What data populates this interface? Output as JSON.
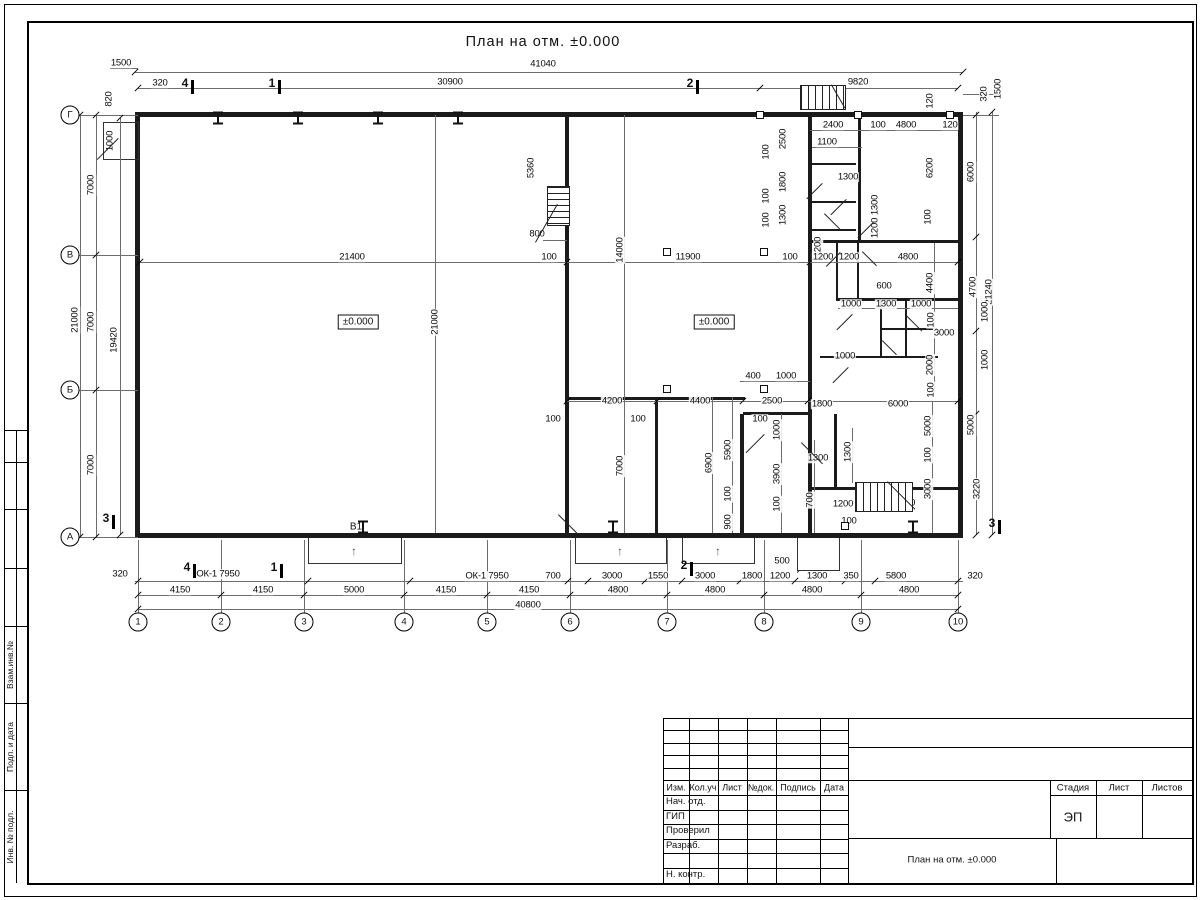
{
  "page": {
    "title": "План на отм. ±0.000"
  },
  "drawing": {
    "labels": [
      {
        "t": "41040",
        "x": 543,
        "y": 64
      },
      {
        "t": "30900",
        "x": 450,
        "y": 82
      },
      {
        "t": "9820",
        "x": 858,
        "y": 82
      },
      {
        "t": "1500",
        "x": 121,
        "y": 63
      },
      {
        "t": "320",
        "x": 160,
        "y": 83
      },
      {
        "t": "820",
        "x": 109,
        "y": 99,
        "r": 1
      },
      {
        "t": "1000",
        "x": 110,
        "y": 141,
        "r": 1
      },
      {
        "t": "120",
        "x": 930,
        "y": 101,
        "r": 1
      },
      {
        "t": "320",
        "x": 984,
        "y": 94,
        "r": 1
      },
      {
        "t": "1500",
        "x": 998,
        "y": 89,
        "r": 1
      },
      {
        "t": "2400",
        "x": 833,
        "y": 125
      },
      {
        "t": "100",
        "x": 878,
        "y": 125
      },
      {
        "t": "4800",
        "x": 906,
        "y": 125
      },
      {
        "t": "120",
        "x": 950,
        "y": 125
      },
      {
        "t": "1100",
        "x": 827,
        "y": 142
      },
      {
        "t": "2500",
        "x": 783,
        "y": 139,
        "r": 1
      },
      {
        "t": "100",
        "x": 766,
        "y": 152,
        "r": 1
      },
      {
        "t": "1800",
        "x": 783,
        "y": 182,
        "r": 1
      },
      {
        "t": "100",
        "x": 766,
        "y": 196,
        "r": 1
      },
      {
        "t": "1300",
        "x": 783,
        "y": 215,
        "r": 1
      },
      {
        "t": "100",
        "x": 766,
        "y": 220,
        "r": 1
      },
      {
        "t": "1300",
        "x": 848,
        "y": 177
      },
      {
        "t": "1300",
        "x": 875,
        "y": 205,
        "r": 1
      },
      {
        "t": "1200",
        "x": 875,
        "y": 228,
        "r": 1
      },
      {
        "t": "1200",
        "x": 818,
        "y": 247,
        "r": 1
      },
      {
        "t": "6200",
        "x": 930,
        "y": 168,
        "r": 1
      },
      {
        "t": "6000",
        "x": 971,
        "y": 172,
        "r": 1
      },
      {
        "t": "100",
        "x": 928,
        "y": 217,
        "r": 1
      },
      {
        "t": "5360",
        "x": 531,
        "y": 168,
        "r": 1
      },
      {
        "t": "800",
        "x": 537,
        "y": 234
      },
      {
        "t": "21400",
        "x": 352,
        "y": 257
      },
      {
        "t": "100",
        "x": 549,
        "y": 257
      },
      {
        "t": "14000",
        "x": 620,
        "y": 250,
        "r": 1
      },
      {
        "t": "11900",
        "x": 688,
        "y": 257
      },
      {
        "t": "100",
        "x": 790,
        "y": 257
      },
      {
        "t": "1200",
        "x": 823,
        "y": 257
      },
      {
        "t": "1200",
        "x": 849,
        "y": 257
      },
      {
        "t": "4800",
        "x": 908,
        "y": 257
      },
      {
        "t": "600",
        "x": 884,
        "y": 286
      },
      {
        "t": "1000",
        "x": 851,
        "y": 304
      },
      {
        "t": "1300",
        "x": 886,
        "y": 304
      },
      {
        "t": "1000",
        "x": 921,
        "y": 304
      },
      {
        "t": "100",
        "x": 931,
        "y": 320,
        "r": 1
      },
      {
        "t": "4400",
        "x": 930,
        "y": 283,
        "r": 1
      },
      {
        "t": "4700",
        "x": 973,
        "y": 287,
        "r": 1
      },
      {
        "t": "21240",
        "x": 989,
        "y": 292,
        "r": 1
      },
      {
        "t": "1000",
        "x": 985,
        "y": 312,
        "r": 1
      },
      {
        "t": "3000",
        "x": 944,
        "y": 333
      },
      {
        "t": "1000",
        "x": 985,
        "y": 360,
        "r": 1
      },
      {
        "t": "1000",
        "x": 845,
        "y": 356
      },
      {
        "t": "2000",
        "x": 930,
        "y": 365,
        "r": 1
      },
      {
        "t": "100",
        "x": 931,
        "y": 390,
        "r": 1
      },
      {
        "t": "21000",
        "x": 435,
        "y": 322,
        "r": 1
      },
      {
        "t": "400",
        "x": 753,
        "y": 376
      },
      {
        "t": "1000",
        "x": 786,
        "y": 376
      },
      {
        "t": "4200",
        "x": 612,
        "y": 401
      },
      {
        "t": "100",
        "x": 553,
        "y": 419
      },
      {
        "t": "100",
        "x": 638,
        "y": 419
      },
      {
        "t": "100",
        "x": 760,
        "y": 419
      },
      {
        "t": "4400",
        "x": 700,
        "y": 401
      },
      {
        "t": "2500",
        "x": 772,
        "y": 401
      },
      {
        "t": "1800",
        "x": 822,
        "y": 404
      },
      {
        "t": "6000",
        "x": 898,
        "y": 404
      },
      {
        "t": "7000",
        "x": 620,
        "y": 466,
        "r": 1
      },
      {
        "t": "6900",
        "x": 709,
        "y": 463,
        "r": 1
      },
      {
        "t": "5900",
        "x": 728,
        "y": 450,
        "r": 1
      },
      {
        "t": "100",
        "x": 728,
        "y": 494,
        "r": 1
      },
      {
        "t": "900",
        "x": 728,
        "y": 522,
        "r": 1
      },
      {
        "t": "1000",
        "x": 777,
        "y": 430,
        "r": 1
      },
      {
        "t": "3900",
        "x": 777,
        "y": 474,
        "r": 1
      },
      {
        "t": "100",
        "x": 777,
        "y": 504,
        "r": 1
      },
      {
        "t": "700",
        "x": 810,
        "y": 500,
        "r": 1
      },
      {
        "t": "1300",
        "x": 818,
        "y": 458
      },
      {
        "t": "1300",
        "x": 848,
        "y": 452,
        "r": 1
      },
      {
        "t": "5000",
        "x": 928,
        "y": 426,
        "r": 1
      },
      {
        "t": "100",
        "x": 928,
        "y": 455,
        "r": 1
      },
      {
        "t": "3000",
        "x": 928,
        "y": 489,
        "r": 1
      },
      {
        "t": "5000",
        "x": 971,
        "y": 425,
        "r": 1
      },
      {
        "t": "3220",
        "x": 977,
        "y": 489,
        "r": 1
      },
      {
        "t": "1200",
        "x": 843,
        "y": 504
      },
      {
        "t": "100",
        "x": 849,
        "y": 521
      },
      {
        "t": "4800",
        "x": 905,
        "y": 503
      },
      {
        "t": "500",
        "x": 782,
        "y": 561
      },
      {
        "t": "320",
        "x": 120,
        "y": 574
      },
      {
        "t": "ОК-1 7950",
        "x": 218,
        "y": 574
      },
      {
        "t": "4150",
        "x": 180,
        "y": 590
      },
      {
        "t": "4150",
        "x": 263,
        "y": 590
      },
      {
        "t": "5000",
        "x": 354,
        "y": 590
      },
      {
        "t": "4150",
        "x": 446,
        "y": 590
      },
      {
        "t": "4150",
        "x": 529,
        "y": 590
      },
      {
        "t": "ОК-1 7950",
        "x": 487,
        "y": 576
      },
      {
        "t": "700",
        "x": 553,
        "y": 576
      },
      {
        "t": "3000",
        "x": 612,
        "y": 576
      },
      {
        "t": "1550",
        "x": 658,
        "y": 576
      },
      {
        "t": "3000",
        "x": 705,
        "y": 576
      },
      {
        "t": "1800",
        "x": 752,
        "y": 576
      },
      {
        "t": "1200",
        "x": 780,
        "y": 576
      },
      {
        "t": "1300",
        "x": 817,
        "y": 576
      },
      {
        "t": "350",
        "x": 851,
        "y": 576
      },
      {
        "t": "5800",
        "x": 896,
        "y": 576
      },
      {
        "t": "320",
        "x": 975,
        "y": 576
      },
      {
        "t": "4800",
        "x": 618,
        "y": 590
      },
      {
        "t": "4800",
        "x": 715,
        "y": 590
      },
      {
        "t": "4800",
        "x": 812,
        "y": 590
      },
      {
        "t": "4800",
        "x": 909,
        "y": 590
      },
      {
        "t": "40800",
        "x": 528,
        "y": 605
      },
      {
        "t": "7000",
        "x": 91,
        "y": 185,
        "r": 1
      },
      {
        "t": "21000",
        "x": 75,
        "y": 320,
        "r": 1
      },
      {
        "t": "7000",
        "x": 91,
        "y": 322,
        "r": 1
      },
      {
        "t": "19420",
        "x": 114,
        "y": 340,
        "r": 1
      },
      {
        "t": "7000",
        "x": 91,
        "y": 465,
        "r": 1
      }
    ],
    "boxed_labels": [
      {
        "t": "±0.000",
        "x": 358,
        "y": 322
      },
      {
        "t": "±0.000",
        "x": 714,
        "y": 322
      }
    ],
    "notes": [
      {
        "t": "В1",
        "x": 356,
        "y": 527
      }
    ],
    "axis_bottom": [
      {
        "t": "1",
        "x": 138
      },
      {
        "t": "2",
        "x": 221
      },
      {
        "t": "3",
        "x": 304
      },
      {
        "t": "4",
        "x": 404
      },
      {
        "t": "5",
        "x": 487
      },
      {
        "t": "6",
        "x": 570
      },
      {
        "t": "7",
        "x": 667
      },
      {
        "t": "8",
        "x": 764
      },
      {
        "t": "9",
        "x": 861
      },
      {
        "t": "10",
        "x": 958
      }
    ],
    "axis_left": [
      {
        "t": "Г",
        "y": 115
      },
      {
        "t": "В",
        "y": 255
      },
      {
        "t": "Б",
        "y": 390
      },
      {
        "t": "А",
        "y": 537
      }
    ],
    "sections": [
      {
        "t": "4",
        "x": 185,
        "y": 83
      },
      {
        "t": "1",
        "x": 272,
        "y": 83
      },
      {
        "t": "2",
        "x": 690,
        "y": 83
      },
      {
        "t": "4",
        "x": 187,
        "y": 567
      },
      {
        "t": "1",
        "x": 274,
        "y": 567
      },
      {
        "t": "2",
        "x": 684,
        "y": 565
      },
      {
        "t": "3",
        "x": 106,
        "y": 518
      },
      {
        "t": "3",
        "x": 992,
        "y": 523
      }
    ],
    "walls": [
      [
        135,
        112,
        828,
        5
      ],
      [
        135,
        533,
        828,
        5
      ],
      [
        135,
        112,
        5,
        426
      ],
      [
        958,
        112,
        5,
        426
      ],
      [
        565,
        112,
        4,
        426
      ],
      [
        808,
        112,
        4,
        302
      ],
      [
        858,
        112,
        3,
        131
      ],
      [
        808,
        240,
        153,
        3
      ],
      [
        810,
        163,
        46,
        2
      ],
      [
        810,
        201,
        46,
        2
      ],
      [
        810,
        229,
        46,
        2
      ],
      [
        836,
        243,
        2,
        57
      ],
      [
        857,
        243,
        2,
        57
      ],
      [
        836,
        298,
        122,
        3
      ],
      [
        880,
        301,
        2,
        57
      ],
      [
        880,
        328,
        57,
        2
      ],
      [
        905,
        301,
        2,
        57
      ],
      [
        820,
        356,
        118,
        2
      ],
      [
        569,
        397,
        176,
        3
      ],
      [
        655,
        397,
        3,
        136
      ],
      [
        740,
        414,
        4,
        119
      ],
      [
        743,
        412,
        65,
        3
      ],
      [
        808,
        414,
        4,
        73
      ],
      [
        834,
        414,
        3,
        75
      ],
      [
        808,
        487,
        153,
        3
      ],
      [
        808,
        487,
        4,
        46
      ],
      [
        103,
        122,
        34,
        36
      ]
    ],
    "thin_h": [
      [
        135,
        72,
        828
      ],
      [
        138,
        88,
        622
      ],
      [
        760,
        88,
        198
      ],
      [
        110,
        68,
        28
      ],
      [
        140,
        262,
        818
      ],
      [
        567,
        401,
        391
      ],
      [
        838,
        308,
        120
      ],
      [
        740,
        381,
        70
      ],
      [
        810,
        130,
        148
      ],
      [
        812,
        147,
        50
      ],
      [
        543,
        240,
        24
      ],
      [
        135,
        581,
        828
      ],
      [
        138,
        595,
        820
      ],
      [
        138,
        609,
        820
      ],
      [
        78,
        115,
        60
      ],
      [
        78,
        255,
        60
      ],
      [
        78,
        390,
        60
      ],
      [
        78,
        537,
        60
      ],
      [
        963,
        94,
        36
      ],
      [
        963,
        115,
        36
      ]
    ],
    "thin_v": [
      [
        80,
        115,
        422
      ],
      [
        96,
        115,
        422
      ],
      [
        120,
        118,
        417
      ],
      [
        435,
        115,
        418
      ],
      [
        624,
        115,
        418
      ],
      [
        976,
        112,
        423
      ],
      [
        992,
        112,
        423
      ],
      [
        934,
        243,
        149
      ],
      [
        712,
        397,
        136
      ],
      [
        732,
        397,
        136
      ],
      [
        781,
        414,
        119
      ],
      [
        814,
        440,
        93
      ],
      [
        852,
        428,
        55
      ],
      [
        932,
        401,
        132
      ],
      [
        138,
        540,
        74
      ],
      [
        221,
        540,
        74
      ],
      [
        304,
        540,
        74
      ],
      [
        404,
        540,
        74
      ],
      [
        487,
        540,
        74
      ],
      [
        570,
        540,
        74
      ],
      [
        667,
        540,
        74
      ],
      [
        764,
        540,
        74
      ],
      [
        861,
        540,
        74
      ],
      [
        958,
        540,
        74
      ]
    ],
    "ticks_h": [
      {
        "y": 595,
        "xs": [
          138,
          221,
          304,
          404,
          487,
          570,
          667,
          764,
          861,
          958
        ]
      },
      {
        "y": 609,
        "xs": [
          138,
          958
        ]
      },
      {
        "y": 581,
        "xs": [
          138,
          308,
          410,
          568,
          588,
          645,
          682,
          740,
          795,
          845,
          875,
          958
        ]
      },
      {
        "y": 72,
        "xs": [
          135,
          963
        ]
      },
      {
        "y": 88,
        "xs": [
          138,
          760,
          958
        ]
      },
      {
        "y": 262,
        "xs": [
          140,
          567,
          810,
          958
        ]
      },
      {
        "y": 401,
        "xs": [
          567,
          657,
          743,
          808,
          958
        ]
      }
    ],
    "ticks_v": [
      {
        "x": 80,
        "ys": [
          115,
          537
        ]
      },
      {
        "x": 96,
        "ys": [
          115,
          255,
          390,
          537
        ]
      },
      {
        "x": 120,
        "ys": [
          118,
          535
        ]
      },
      {
        "x": 976,
        "ys": [
          115,
          237,
          331,
          414,
          489,
          535
        ]
      },
      {
        "x": 992,
        "ys": [
          112,
          535
        ]
      }
    ],
    "squares": [
      [
        667,
        252
      ],
      [
        764,
        252
      ],
      [
        667,
        389
      ],
      [
        764,
        389
      ],
      [
        760,
        115
      ],
      [
        858,
        115
      ],
      [
        950,
        115
      ],
      [
        845,
        526
      ]
    ],
    "piers_top": [
      [
        218,
        118
      ],
      [
        298,
        118
      ],
      [
        378,
        118
      ],
      [
        458,
        118
      ]
    ],
    "piers_bottom": [
      [
        363,
        527
      ],
      [
        613,
        527
      ],
      [
        913,
        527
      ]
    ],
    "doors": [
      [
        822,
        183,
        45,
        22
      ],
      [
        824,
        214,
        -45,
        22
      ],
      [
        846,
        199,
        45,
        22
      ],
      [
        873,
        222,
        45,
        22
      ],
      [
        840,
        252,
        45,
        20
      ],
      [
        862,
        252,
        -45,
        20
      ],
      [
        852,
        314,
        45,
        22
      ],
      [
        906,
        316,
        -45,
        22
      ],
      [
        882,
        341,
        -45,
        20
      ],
      [
        848,
        367,
        45,
        22
      ],
      [
        764,
        434,
        45,
        26
      ],
      [
        801,
        443,
        -45,
        30
      ],
      [
        558,
        515,
        -45,
        26
      ],
      [
        818,
        551,
        45,
        30
      ],
      [
        118,
        138,
        45,
        30
      ]
    ],
    "stairs": [
      {
        "x": 547,
        "y": 186,
        "w": 21,
        "h": 38,
        "dir": "h",
        "diag": {
          "x": 557,
          "y": 204,
          "len": 44,
          "rot": 30
        }
      },
      {
        "x": 855,
        "y": 482,
        "w": 56,
        "h": 28,
        "dir": "v",
        "diag": {
          "x": 887,
          "y": 482,
          "len": 39,
          "rot": -45
        }
      },
      {
        "x": 800,
        "y": 85,
        "w": 44,
        "h": 23,
        "dir": "v",
        "diag": {
          "x": 831,
          "y": 85,
          "len": 27,
          "rot": -30
        }
      }
    ],
    "platforms": [
      [
        308,
        538,
        92,
        25
      ],
      [
        575,
        538,
        90,
        25
      ],
      [
        682,
        538,
        71,
        25
      ],
      [
        797,
        538,
        41,
        32
      ]
    ],
    "arrows": [
      {
        "x": 354,
        "y": 551
      },
      {
        "x": 620,
        "y": 551
      },
      {
        "x": 718,
        "y": 551
      }
    ]
  },
  "title_block": {
    "cols": [
      "Изм.",
      "Кол.уч",
      "Лист",
      "№док.",
      "Подпись",
      "Дата"
    ],
    "rows": [
      "Нач. отд.",
      "ГИП",
      "Проверил",
      "Разраб.",
      "",
      "Н. контр."
    ],
    "stage_label": "Стадия",
    "sheet_label": "Лист",
    "sheets_label": "Листов",
    "stage_value": "ЭП",
    "doc_title": "План на отм. ±0.000"
  },
  "side_stamp": {
    "labels": [
      "Взам.инв.№",
      "Подп. и дата",
      "Инв. № подл."
    ]
  }
}
